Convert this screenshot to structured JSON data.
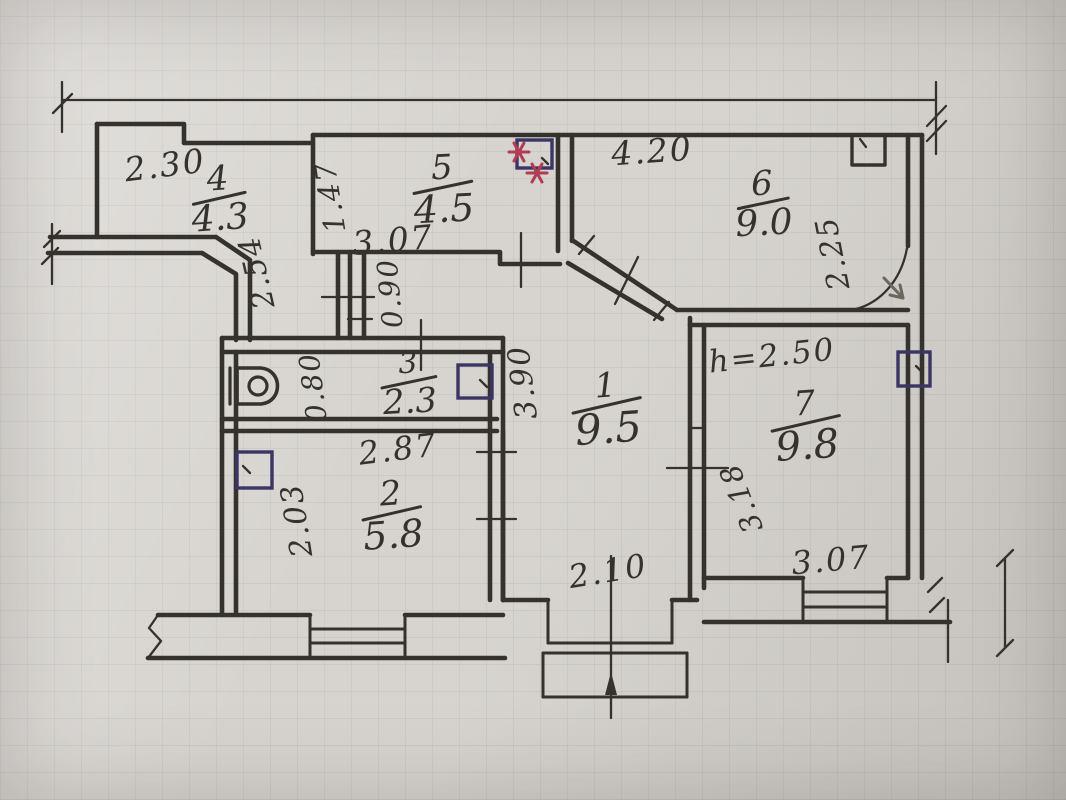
{
  "photo": {
    "description": "Hand-drawn apartment floor plan sketch on squared paper"
  },
  "colors": {
    "paper": "#d7d4cf",
    "ink": "#35322d",
    "vent_ink": "#3b3566",
    "star_red": "#b23b55",
    "pencil": "#6b675e"
  },
  "ceiling_height": "h=2.50",
  "rooms": [
    {
      "number": "1",
      "area": "9.5"
    },
    {
      "number": "2",
      "area": "5.8"
    },
    {
      "number": "3",
      "area": "2.3"
    },
    {
      "number": "4",
      "area": "4.3"
    },
    {
      "number": "5",
      "area": "4.5"
    },
    {
      "number": "6",
      "area": "9.0"
    },
    {
      "number": "7",
      "area": "9.8"
    }
  ],
  "icons": {
    "toilet": "toilet-top-view",
    "vent": "ventilation-shaft-square",
    "stars": "red-asterisk-marks",
    "entrance": "entrance-door-swing-arc",
    "break": "wall-break-zigzag",
    "windows": "triple-line-window"
  },
  "plan": {
    "room_labels": [
      {
        "number": "4",
        "area": "4.3",
        "x": 219,
        "y": 200,
        "rot": -4,
        "barW": 56,
        "numSize": 34,
        "areaSize": 36
      },
      {
        "number": "5",
        "area": "4.5",
        "x": 443,
        "y": 190,
        "rot": -3,
        "barW": 62,
        "numSize": 34,
        "areaSize": 38
      },
      {
        "number": "6",
        "area": "9.0",
        "x": 763,
        "y": 205,
        "rot": -3,
        "barW": 54,
        "numSize": 34,
        "areaSize": 36
      },
      {
        "number": "3",
        "area": "2.3",
        "x": 409,
        "y": 384,
        "rot": -3,
        "barW": 58,
        "numSize": 30,
        "areaSize": 34
      },
      {
        "number": "1",
        "area": "9.5",
        "x": 607,
        "y": 410,
        "rot": -4,
        "barW": 72,
        "numSize": 34,
        "areaSize": 42
      },
      {
        "number": "7",
        "area": "9.8",
        "x": 806,
        "y": 427,
        "rot": -4,
        "barW": 72,
        "numSize": 34,
        "areaSize": 40
      },
      {
        "number": "2",
        "area": "5.8",
        "x": 392,
        "y": 516,
        "rot": -4,
        "barW": 62,
        "numSize": 34,
        "areaSize": 38
      }
    ],
    "dim_labels": [
      {
        "text": "2.30",
        "x": 165,
        "y": 165,
        "rot": -7,
        "size": 33
      },
      {
        "text": "1.47",
        "x": 330,
        "y": 197,
        "rot": -99,
        "size": 29
      },
      {
        "text": "3.07",
        "x": 393,
        "y": 240,
        "rot": -5,
        "size": 33
      },
      {
        "text": "4.20",
        "x": 652,
        "y": 151,
        "rot": -4,
        "size": 33
      },
      {
        "text": "2.25",
        "x": 833,
        "y": 253,
        "rot": -101,
        "size": 30
      },
      {
        "text": "2.54",
        "x": 257,
        "y": 272,
        "rot": -103,
        "size": 30
      },
      {
        "text": "0.90",
        "x": 390,
        "y": 293,
        "rot": -95,
        "size": 28
      },
      {
        "text": "0.80",
        "x": 313,
        "y": 387,
        "rot": -97,
        "size": 28
      },
      {
        "text": "3.90",
        "x": 523,
        "y": 382,
        "rot": -97,
        "size": 30
      },
      {
        "text": "h=2.50",
        "x": 772,
        "y": 356,
        "rot": -6,
        "size": 31
      },
      {
        "text": "2.87",
        "x": 398,
        "y": 449,
        "rot": -7,
        "size": 32
      },
      {
        "text": "2.03",
        "x": 297,
        "y": 520,
        "rot": -99,
        "size": 30
      },
      {
        "text": "2.10",
        "x": 608,
        "y": 571,
        "rot": -9,
        "size": 32
      },
      {
        "text": "3.18",
        "x": 741,
        "y": 498,
        "rot": -111,
        "size": 29
      },
      {
        "text": "3.07",
        "x": 831,
        "y": 560,
        "rot": -5,
        "size": 32
      }
    ]
  }
}
